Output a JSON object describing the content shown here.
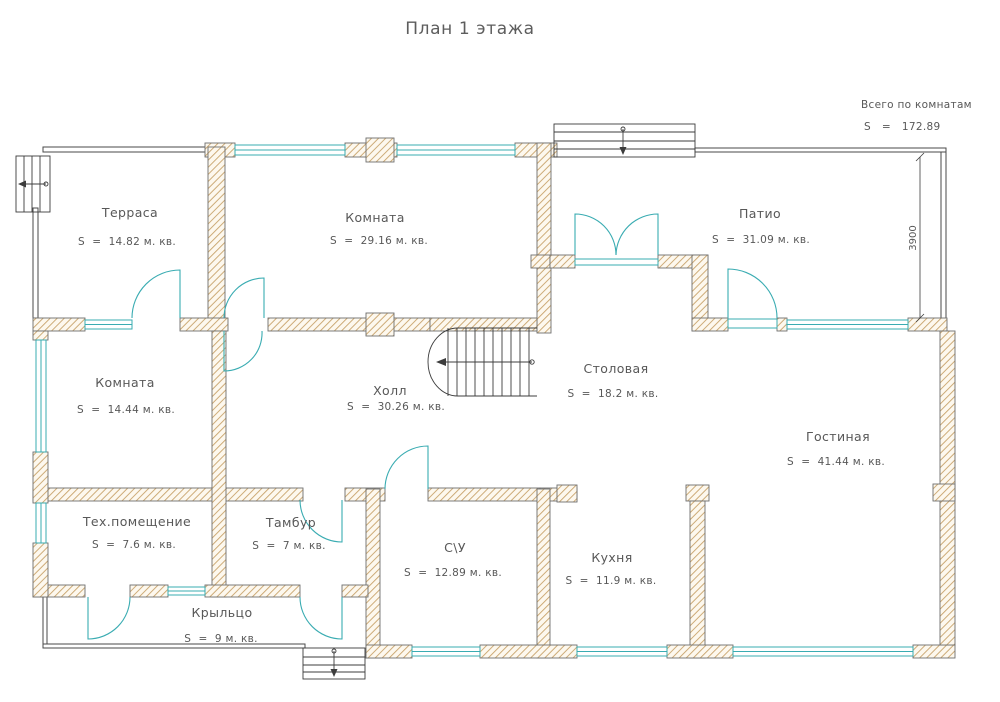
{
  "title": "План 1 этажа",
  "summary": {
    "label": "Всего по комнатам",
    "value": "S   =   172.89"
  },
  "dimension_right": "3900",
  "rooms": {
    "terrace": {
      "name": "Терраса",
      "area": "S  =  14.82 м. кв."
    },
    "room_top": {
      "name": "Комната",
      "area": "S  =  29.16 м. кв."
    },
    "patio": {
      "name": "Патио",
      "area": "S  =  31.09 м. кв."
    },
    "room_left": {
      "name": "Комната",
      "area": "S  =  14.44 м. кв."
    },
    "hall": {
      "name": "Холл",
      "area": "S  =  30.26 м. кв."
    },
    "dining": {
      "name": "Столовая",
      "area": "S  =  18.2 м. кв."
    },
    "living": {
      "name": "Гостиная",
      "area": "S  =  41.44 м. кв."
    },
    "tech": {
      "name": "Тех.помещение",
      "area": "S  =  7.6 м. кв."
    },
    "tambour": {
      "name": "Тамбур",
      "area": "S  =  7 м. кв."
    },
    "wc": {
      "name": "С\\У",
      "area": "S  =  12.89 м. кв."
    },
    "kitchen": {
      "name": "Кухня",
      "area": "S  =  11.9 м. кв."
    },
    "porch": {
      "name": "Крыльцо",
      "area": "S  =  9 м. кв."
    }
  },
  "colors": {
    "wall_hatch": "#c8a36b",
    "wall_fill": "#fdf8ee",
    "outline": "#6e6e6e",
    "glass_teal": "#3aacb2",
    "text_gray": "#585858"
  }
}
